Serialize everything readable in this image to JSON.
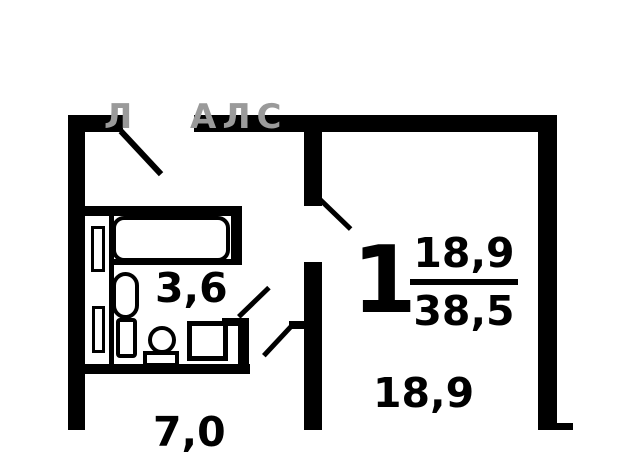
{
  "watermark": {
    "left_part": "Л",
    "right_part": "АЛС",
    "color": "#9a9a9a"
  },
  "labels": {
    "room_number": "1",
    "living_area_numerator": "18,9",
    "total_area_denominator": "38,5",
    "room_area": "18,9",
    "bathroom_area": "3,6",
    "kitchen_area": "7,0"
  },
  "colors": {
    "walls": "#000000",
    "background": "#ffffff"
  },
  "fixtures": [
    "bathtub",
    "toilet",
    "toilet-tank",
    "sink",
    "sink-base",
    "washing-machine",
    "ventilation-duct-upper",
    "ventilation-duct-lower"
  ],
  "doors": [
    "entry-door",
    "living-room-door",
    "bathroom-door",
    "kitchen-door"
  ]
}
